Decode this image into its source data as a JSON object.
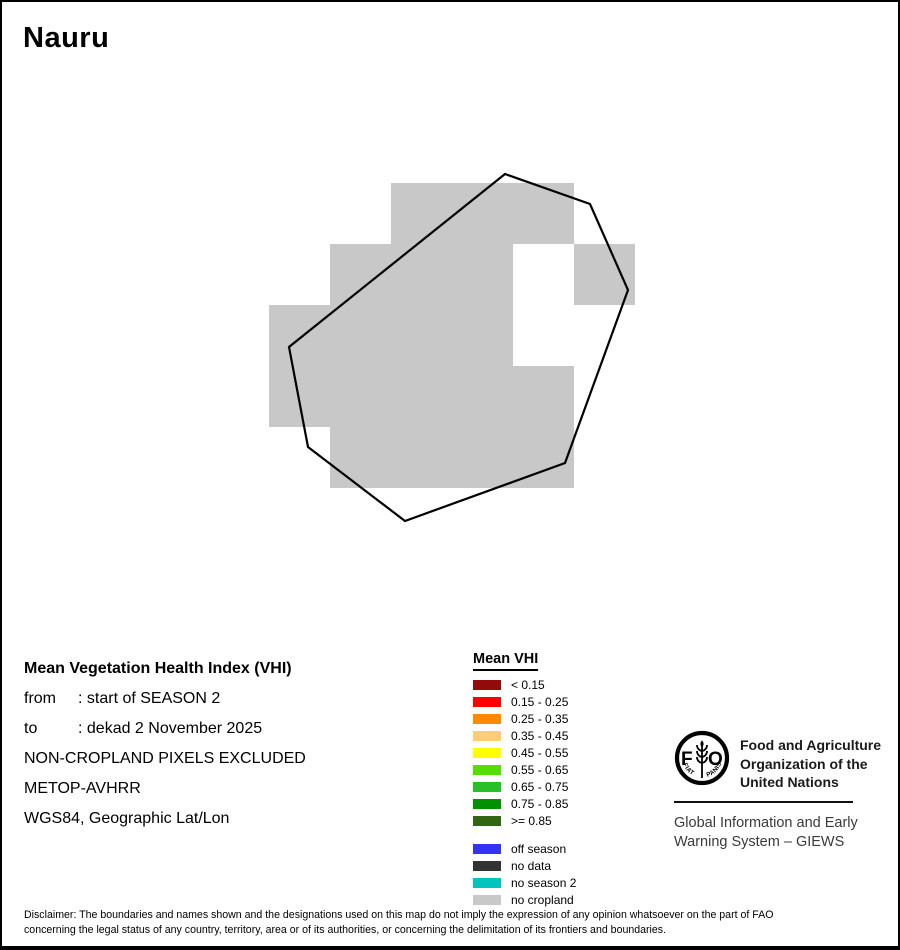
{
  "page": {
    "title": "Nauru"
  },
  "map": {
    "no_cropland_color": "#C8C8C8",
    "outline_color": "#000000",
    "cells": [
      {
        "x": 389,
        "y": 181,
        "w": 183,
        "h": 61
      },
      {
        "x": 328,
        "y": 242,
        "w": 183,
        "h": 61
      },
      {
        "x": 572,
        "y": 242,
        "w": 61,
        "h": 61
      },
      {
        "x": 267,
        "y": 303,
        "w": 244,
        "h": 61
      },
      {
        "x": 267,
        "y": 364,
        "w": 305,
        "h": 61
      },
      {
        "x": 328,
        "y": 425,
        "w": 244,
        "h": 61
      }
    ],
    "outline": [
      [
        503,
        172
      ],
      [
        588,
        202
      ],
      [
        626,
        288
      ],
      [
        563,
        461
      ],
      [
        403,
        519
      ],
      [
        306,
        445
      ],
      [
        287,
        345
      ]
    ]
  },
  "info": {
    "title": "Mean Vegetation Health Index (VHI)",
    "rows": [
      {
        "label": "from",
        "value": ": start of SEASON 2"
      },
      {
        "label": "to",
        "value": ": dekad 2 November 2025"
      },
      {
        "label": "",
        "value": "NON-CROPLAND PIXELS EXCLUDED"
      },
      {
        "label": "",
        "value": "METOP-AVHRR"
      },
      {
        "label": "",
        "value": "WGS84, Geographic Lat/Lon"
      }
    ]
  },
  "legend": {
    "title": "Mean VHI",
    "classes": [
      {
        "label": "< 0.15",
        "color": "#920A0A"
      },
      {
        "label": "0.15 - 0.25",
        "color": "#FF0000"
      },
      {
        "label": "0.25 - 0.35",
        "color": "#FF8A00"
      },
      {
        "label": "0.35 - 0.45",
        "color": "#FFCC78"
      },
      {
        "label": "0.45 - 0.55",
        "color": "#FFFF00"
      },
      {
        "label": "0.55 - 0.65",
        "color": "#52E001"
      },
      {
        "label": "0.65 - 0.75",
        "color": "#28C028"
      },
      {
        "label": "0.75 - 0.85",
        "color": "#009000"
      },
      {
        "label": ">= 0.85",
        "color": "#336613"
      }
    ],
    "extras": [
      {
        "label": "off season",
        "color": "#3533F2"
      },
      {
        "label": "no data",
        "color": "#333333"
      },
      {
        "label": "no season 2",
        "color": "#00C4BE"
      },
      {
        "label": "no cropland",
        "color": "#C8C8C8"
      }
    ]
  },
  "branding": {
    "logo_letters": [
      "F",
      "O"
    ],
    "logo_motto": [
      "FIAT",
      "PANIS"
    ],
    "org_lines": [
      "Food and Agriculture",
      "Organization of the",
      "United Nations"
    ],
    "giews_lines": [
      "Global Information and Early",
      "Warning System – GIEWS"
    ]
  },
  "disclaimer": {
    "lines": [
      "Disclaimer: The boundaries and names shown and the designations used on this map do not imply the expression of any opinion whatsoever on the part of FAO",
      "concerning the legal status of any country, territory, area or of its authorities, or concerning the delimitation of its frontiers and boundaries."
    ]
  }
}
